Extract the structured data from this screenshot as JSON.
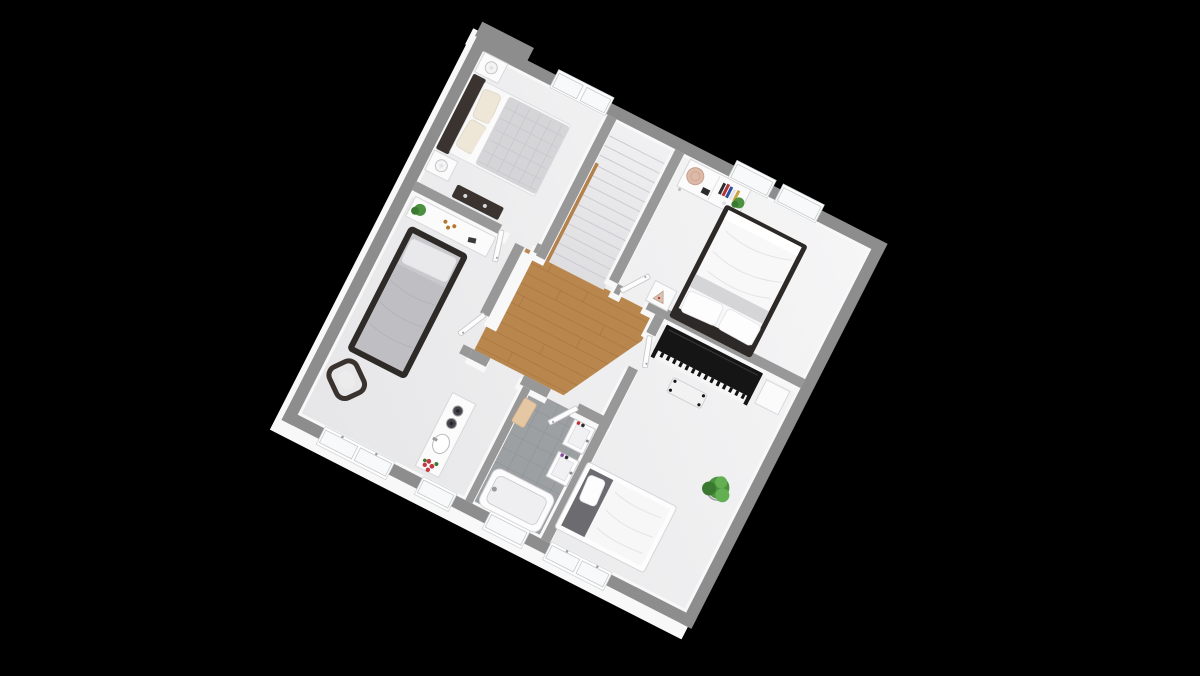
{
  "scene": {
    "type": "3d-floor-plan-render",
    "description": "Isometric 3D floor plan of an upper storey viewed from above, rotated on a black background. No text is visible in the image.",
    "rotation_deg": 27,
    "background": "#000000"
  },
  "palette": {
    "background": "#000000",
    "wall_ext": "#8d8d8d",
    "wall_int": "#989898",
    "wall_face": "#f8f8f8",
    "floor_light": "#f6f6f7",
    "floor_shade": "#e7e7e9",
    "wood": "#b9874e",
    "wood_line": "#a06c36",
    "tile": "#9ca0a3",
    "tile_line": "#8b8f92",
    "stair_line": "#c9c9cd",
    "rail_wood": "#b3814b",
    "furn_white": "#fbfbfc",
    "furn_stroke": "#d8d8db",
    "furn_dark": "#3a3330",
    "furn_black": "#171717",
    "bedding_white": "#f8f8f9",
    "bedding_grey": "#d5d5d8",
    "bedding_darkgrey": "#6b6b70",
    "pillow": "#fdfdfe",
    "pillow_cream": "#eee7d8",
    "plant": "#4c9140",
    "plant_dark": "#3a7a30",
    "plant_light": "#63b052",
    "glass": "#f7f9fa",
    "door": "#fdfdfe",
    "piano_keys": "#f5f5f6",
    "towel": "#e6c7a4",
    "flower": "#c23843",
    "basket": "#dcb9a8"
  },
  "rooms": [
    {
      "id": "bedroom-1",
      "position": "top-left",
      "floor": "light-grey",
      "furniture": [
        "double bed with dark headboard, cream pillows and grey plaid duvet",
        "white nightstand with round table lamp (x2)",
        "dark console table with small objects",
        "double window on top wall"
      ]
    },
    {
      "id": "bedroom-2",
      "position": "left",
      "floor": "light-grey",
      "furniture": [
        "single bed with black frame and grey bedding",
        "white desk with potted plant and amber bottles",
        "dark cantilever chair with light seat cushion",
        "wide window on lower wall"
      ]
    },
    {
      "id": "master-bedroom",
      "position": "top-right",
      "floor": "light-grey",
      "furniture": [
        "double bed with black frame, white duvet, grey throw, two pillows (headboard toward hall wall)",
        "white sideboard with woven basket, camera, books and plant",
        "white nightstand with triangle artwork",
        "two windows on top wall"
      ]
    },
    {
      "id": "music-bedroom",
      "position": "bottom-right",
      "floor": "light-grey",
      "furniture": [
        "black upright piano with white keyboard",
        "piano bench with light seat and black legs",
        "white side table",
        "potted green plant",
        "single bed with white frame, dark grey throw and white pillow",
        "window behind bed"
      ]
    },
    {
      "id": "bathroom",
      "position": "bottom-center",
      "floor": "grey-tile",
      "furniture": [
        "bathtub",
        "two wall-mounted sinks with toiletries",
        "peach towel on rail",
        "small window"
      ]
    },
    {
      "id": "wc-vanity-room",
      "position": "bottom-left-center",
      "floor": "light-grey",
      "furniture": [
        "white vanity unit with oval basin and faucet",
        "two dark round bowls/knobs",
        "red flower bouquet",
        "small window"
      ]
    },
    {
      "id": "hallway",
      "position": "center",
      "floor": "oak-wood",
      "furniture": [
        "oak plank flooring with chamfered corner",
        "open white doors to all rooms"
      ]
    },
    {
      "id": "staircase",
      "position": "center-top",
      "floor": "light-grey",
      "furniture": [
        "straight stair flight descending to lower floor",
        "wooden handrail strip"
      ]
    }
  ],
  "counts": {
    "windows": 7,
    "door_openings": 6,
    "door_leaves": 5,
    "stair_steps": 13
  }
}
